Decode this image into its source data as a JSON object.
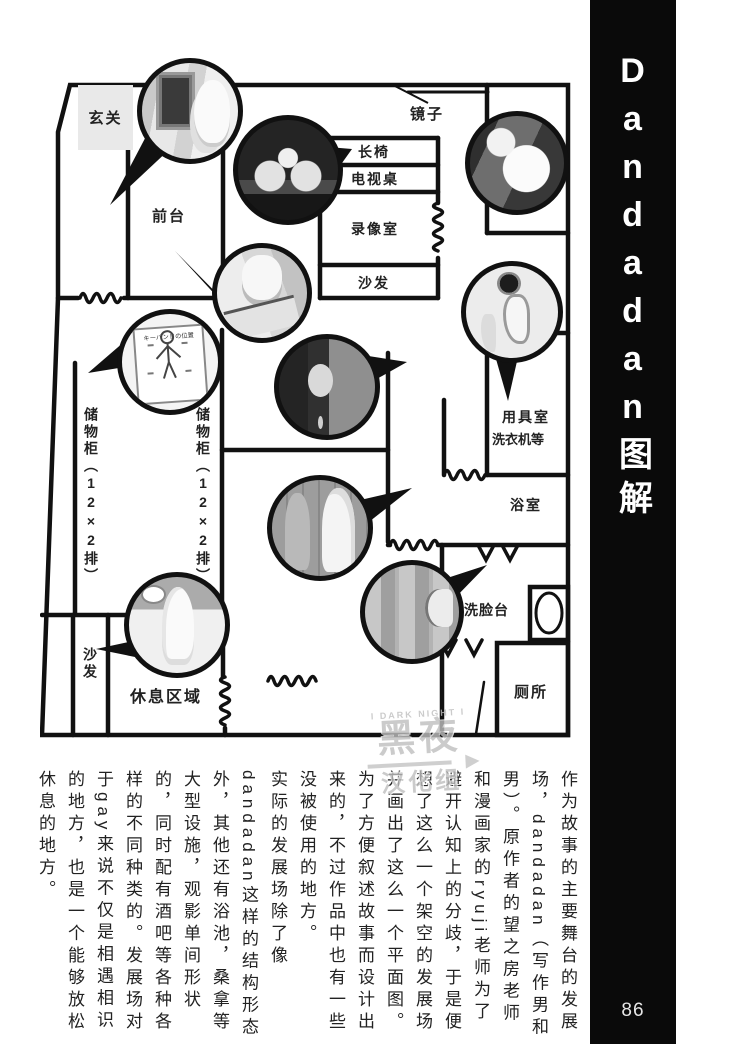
{
  "page": {
    "sidebar_title": "Dandadan图解",
    "number": "86"
  },
  "floor_plan": {
    "rooms": {
      "genkan": "玄关",
      "front_desk": "前台",
      "mirror": "镜子",
      "bench": "长椅",
      "tv_table": "电视桌",
      "video_room": "录像室",
      "sofa_top": "沙发",
      "utility_room": "用具室",
      "utility_note": "洗衣机等",
      "bathroom": "浴室",
      "washbasin": "洗脸台",
      "toilet": "厕所",
      "locker_label": "储物柜（12×2排）",
      "sofa_bottom": "沙发",
      "rest_area": "休息区域"
    },
    "poster_title": "キーバンドの位置",
    "watermark": {
      "top": "I DARK NIGHT I",
      "main": "黑夜",
      "sub": "汉化组"
    }
  },
  "article": {
    "paragraphs": [
      "作为故事的主要舞台的发展场，dandadan（写作男和男）。原作者的望之房老师和漫画家的ryuji老师为了避开认知上的分歧，于是便想了这么一个架空的发展场并画出了这么一个平面图。为了方便叙述故事而设计出来的，不过作品中也有一些没被使用的地方。",
      "实际的发展场除了像dandadan这样的结构形态外，其他还有浴池，桑拿等大型设施，观影单间形状的，同时配有酒吧等各种各样的不同种类的。发展场对于gay来说不仅是相遇相识的地方，也是一个能够放松休息的地方。"
    ]
  },
  "colors": {
    "ink": "#111111",
    "sidebar_bg": "#0a0a0a",
    "watermark_gray": "#bfbfbf",
    "genkan_fill": "#e9e9e9"
  }
}
